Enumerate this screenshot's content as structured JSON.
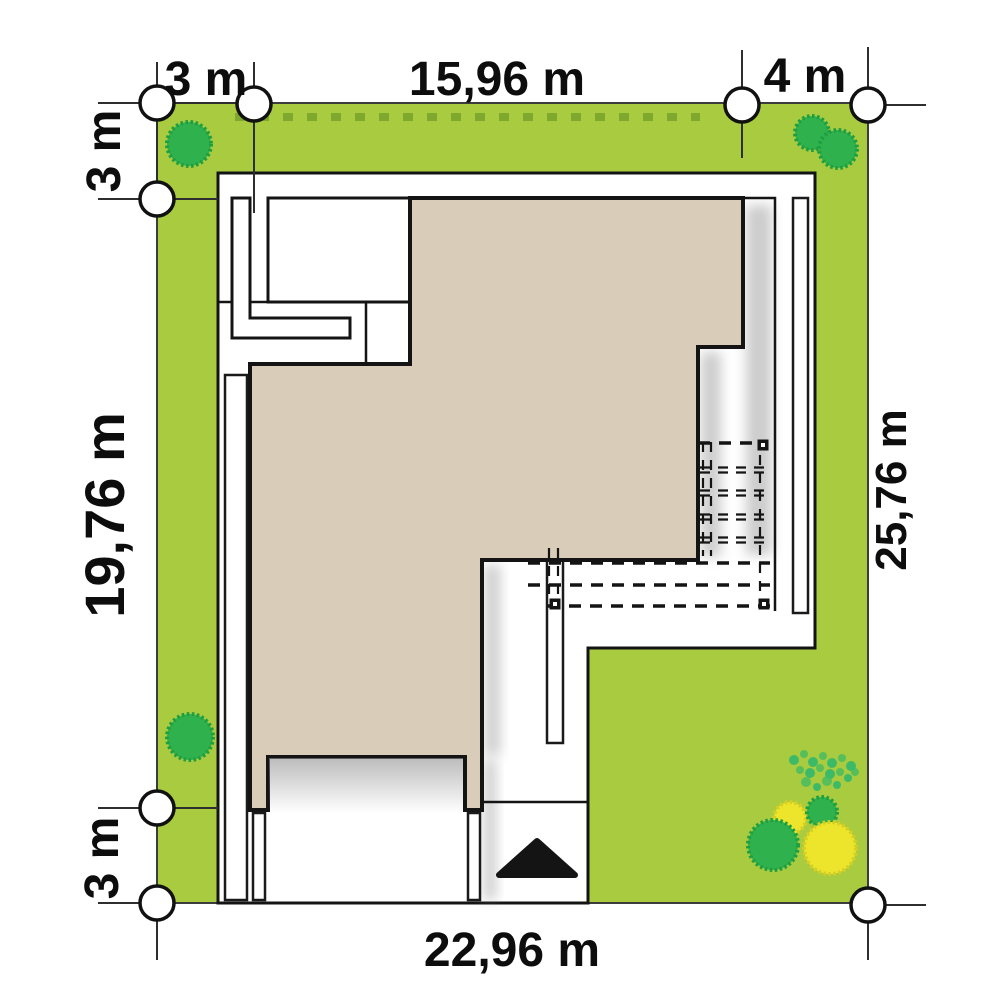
{
  "page": {
    "title": "House site plan with plot dimensions"
  },
  "plan": {
    "dimension_labels": {
      "top_offset_left": "3 m",
      "top_width": "15,96 m",
      "top_offset_right": "4 m",
      "left_offset_top": "3 m",
      "left_height": "19,76 m",
      "right_height": "25,76 m",
      "left_offset_bottom": "3 m",
      "bottom_width": "22,96 m"
    },
    "colors": {
      "lawn": "#A9CB3F",
      "hedge": "#7FA82F",
      "roof": "#D9CCB8",
      "tree": "#2FB24D",
      "shrub_yellow": "#EDE52B",
      "bush": "#3CBA67",
      "outline": "#141414"
    }
  }
}
